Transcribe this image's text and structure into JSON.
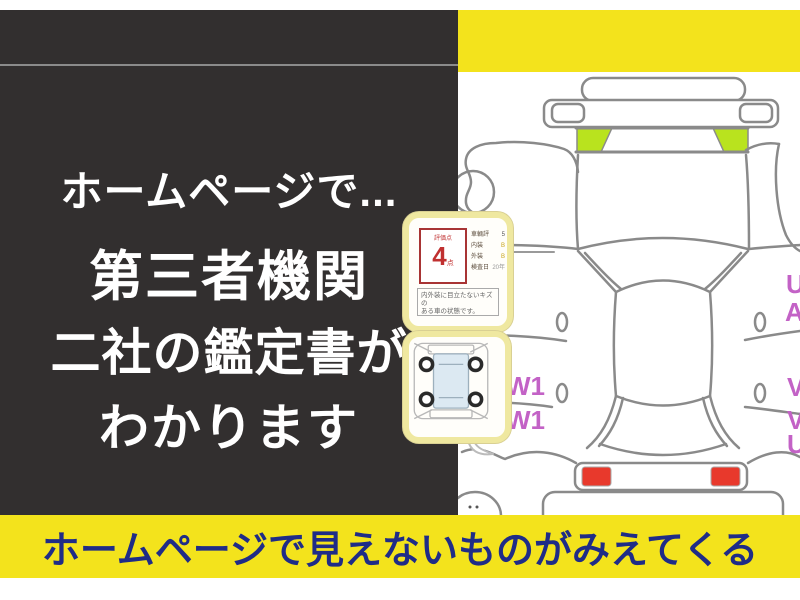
{
  "left_panel": {
    "line1": "ホームページで...",
    "line2": "第三者機関",
    "line3": "二社の鑑定書が",
    "line4": "わかります"
  },
  "bottom_banner": {
    "text": "ホームページで見えないものがみえてくる"
  },
  "certificate_card": {
    "score_label": "評価点",
    "score_value": "4",
    "score_unit": "点",
    "rows": [
      {
        "label": "車輌評",
        "value": "5"
      },
      {
        "label": "内装",
        "value": "B"
      },
      {
        "label": "外装",
        "value": "B"
      },
      {
        "label": "検査日",
        "value": "20年"
      }
    ],
    "note_line1": "内外装に目立たないキズの",
    "note_line2": "ある車の状態です。"
  },
  "diagram": {
    "damage_codes": {
      "left1": "W1",
      "left2": "W1",
      "right1": "U",
      "right2": "A",
      "right3": "V",
      "right4": "V",
      "right5": "U"
    }
  },
  "colors": {
    "panel_dark": "#322f2f",
    "banner_yellow": "#f3e31c",
    "banner_text_navy": "#1f2c87",
    "highlight_green": "#b9e31e",
    "taillight_red": "#e8392c",
    "damage_code_magenta": "#c362c6",
    "card_border_yellow": "#efe8a0",
    "score_red": "#b43434"
  }
}
